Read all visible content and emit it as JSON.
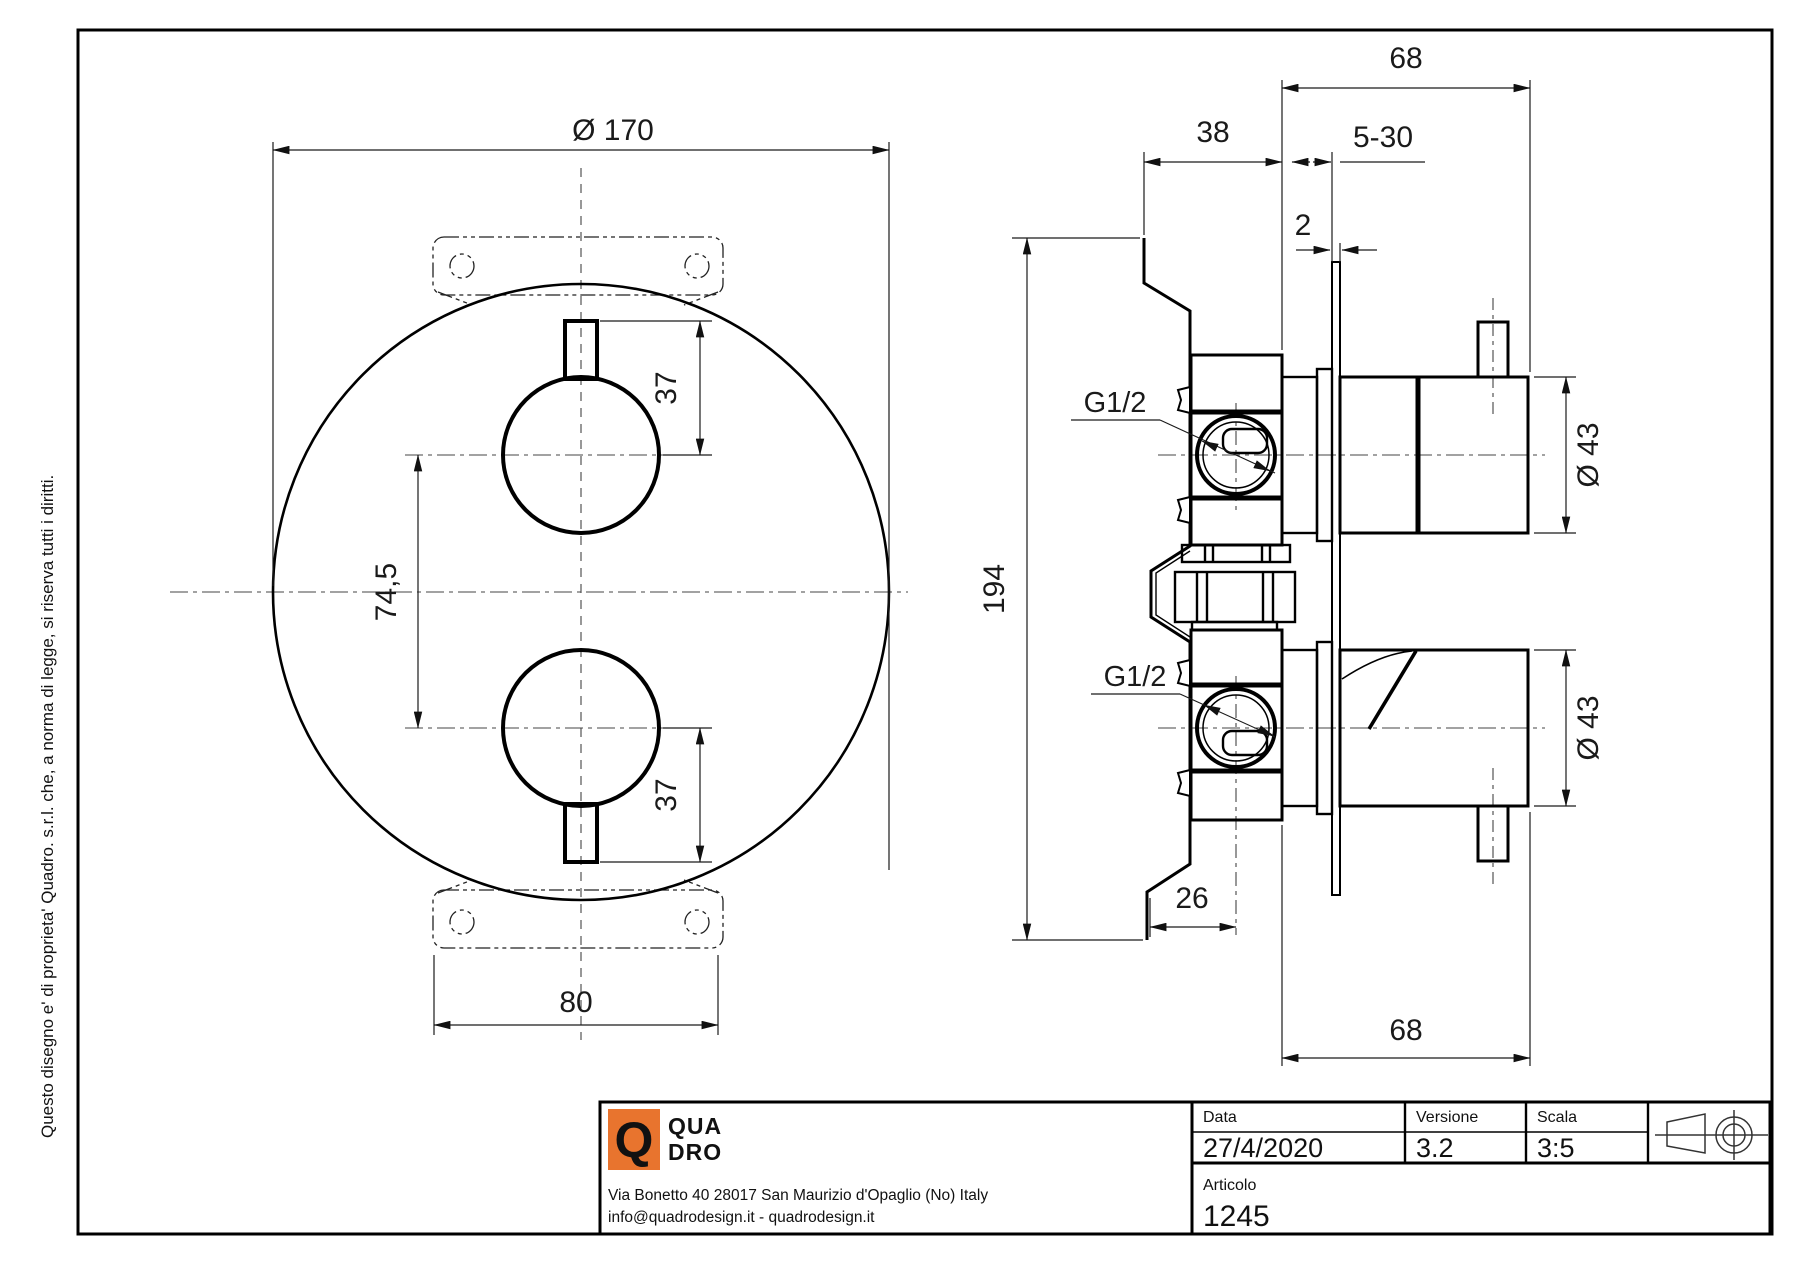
{
  "side_note": "Questo disegno e' di proprieta' Quadro. s.r.l. che, a norma di legge, si riserva tutti i diritti.",
  "drawing": {
    "front_view": {
      "diameter": "Ø 170",
      "knob_offset": "37",
      "knob_spacing": "74,5",
      "plate_width": "80"
    },
    "side_view": {
      "overall_width": "68",
      "body_depth": "38",
      "wall_range": "5-30",
      "plate_thickness": "2",
      "overall_height": "194",
      "port_thread": "G1/2",
      "handle_diameter": "Ø 43",
      "bottom_offset": "26"
    }
  },
  "title_block": {
    "logo": {
      "q": "Q",
      "line1": "QUA",
      "line2": "DRO",
      "color": "#e8742e"
    },
    "address_line1": "Via Bonetto 40  28017 San Maurizio d'Opaglio (No) Italy",
    "address_line2": "info@quadrodesign.it  -  quadrodesign.it",
    "fields": {
      "data_label": "Data",
      "data_value": "27/4/2020",
      "versione_label": "Versione",
      "versione_value": "3.2",
      "scala_label": "Scala",
      "scala_value": "3:5",
      "articolo_label": "Articolo",
      "articolo_value": "1245"
    }
  }
}
